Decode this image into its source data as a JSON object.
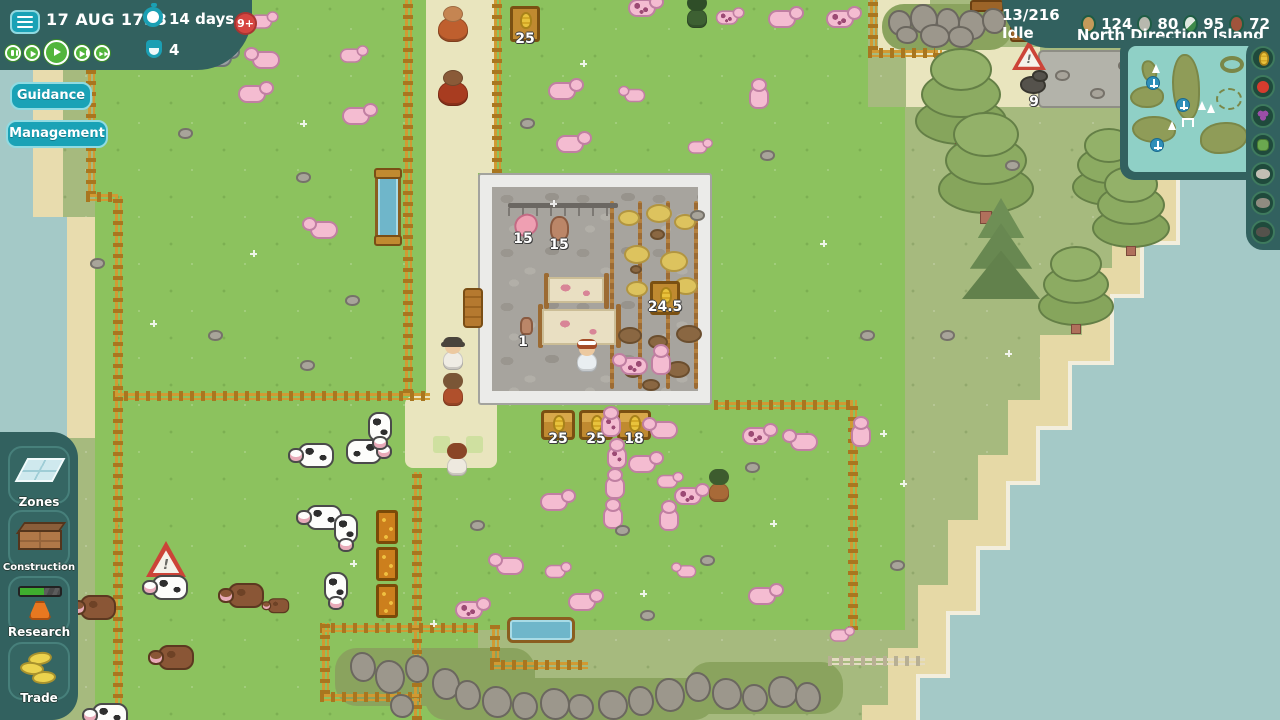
{
  "hud": {
    "date": "17 AUG 1733",
    "timer": "14 days",
    "age_badge": "9+",
    "flask_count": "4",
    "idle": "13/216 Idle",
    "island": "North Direction Island",
    "resources": [
      {
        "name": "logs",
        "count": "124",
        "color": "#c59a5a"
      },
      {
        "name": "stone",
        "count": "80",
        "color": "#b8b8ae"
      },
      {
        "name": "tools",
        "count": "95",
        "color": "#dfe8df"
      },
      {
        "name": "bricks",
        "count": "72",
        "color": "#a0543c"
      }
    ],
    "buttons": {
      "guidance": "Guidance",
      "management": "Management"
    }
  },
  "sidebar": {
    "items": [
      {
        "id": "zones",
        "label": "Zones"
      },
      {
        "id": "construction",
        "label": "Construction"
      },
      {
        "id": "research",
        "label": "Research"
      },
      {
        "id": "trade",
        "label": "Trade"
      }
    ]
  },
  "minimap": {
    "filters": [
      "corn",
      "apple",
      "grapes",
      "cabbage",
      "stone",
      "rock",
      "coal"
    ]
  },
  "world": {
    "labels": {
      "corn_sign_top": "25",
      "feed_trough_1": "25",
      "feed_trough_2": "25",
      "feed_trough_3": "18",
      "hanging_meat": "15",
      "hanging_carcass": "15",
      "hide_count": "1",
      "barn_corn_sign": "24.5",
      "rock_pile": "9"
    }
  },
  "colors": {
    "panel_teal": "#32615f",
    "button_teal": "#1aa2b6",
    "play_green": "#52b53c",
    "badge_red": "#d64541"
  }
}
